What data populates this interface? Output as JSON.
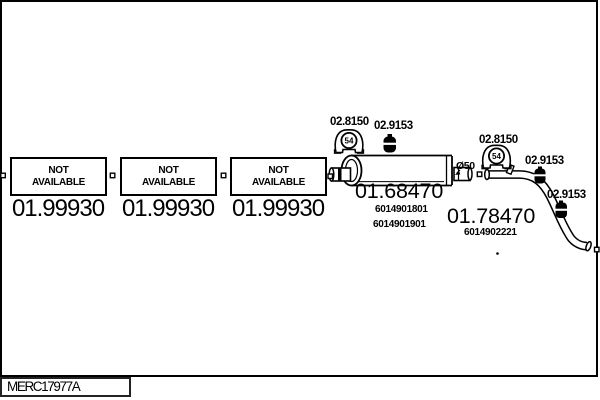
{
  "colors": {
    "ink": "#000000",
    "background": "#ffffff"
  },
  "drawing": {
    "na_boxes": [
      {
        "line1": "NOT",
        "line2": "AVAILABLE",
        "part_number": "01.99930"
      },
      {
        "line1": "NOT",
        "line2": "AVAILABLE",
        "part_number": "01.99930"
      },
      {
        "line1": "NOT",
        "line2": "AVAILABLE",
        "part_number": "01.99930"
      }
    ],
    "muffler": {
      "part_number": "01.68470",
      "oem_numbers": [
        "6014901801",
        "6014901901"
      ],
      "diameter_label": "Ø50"
    },
    "tailpipe": {
      "part_number": "01.78470",
      "oem_number": "6014902221"
    },
    "hangers": [
      {
        "label": "02.8150",
        "badge": "54"
      },
      {
        "label": "02.8150",
        "badge": "54"
      }
    ],
    "mounts": [
      {
        "label": "02.9153"
      },
      {
        "label": "02.9153"
      },
      {
        "label": "02.9153"
      }
    ]
  },
  "footer": {
    "diagram_code": "MERC17977A"
  }
}
